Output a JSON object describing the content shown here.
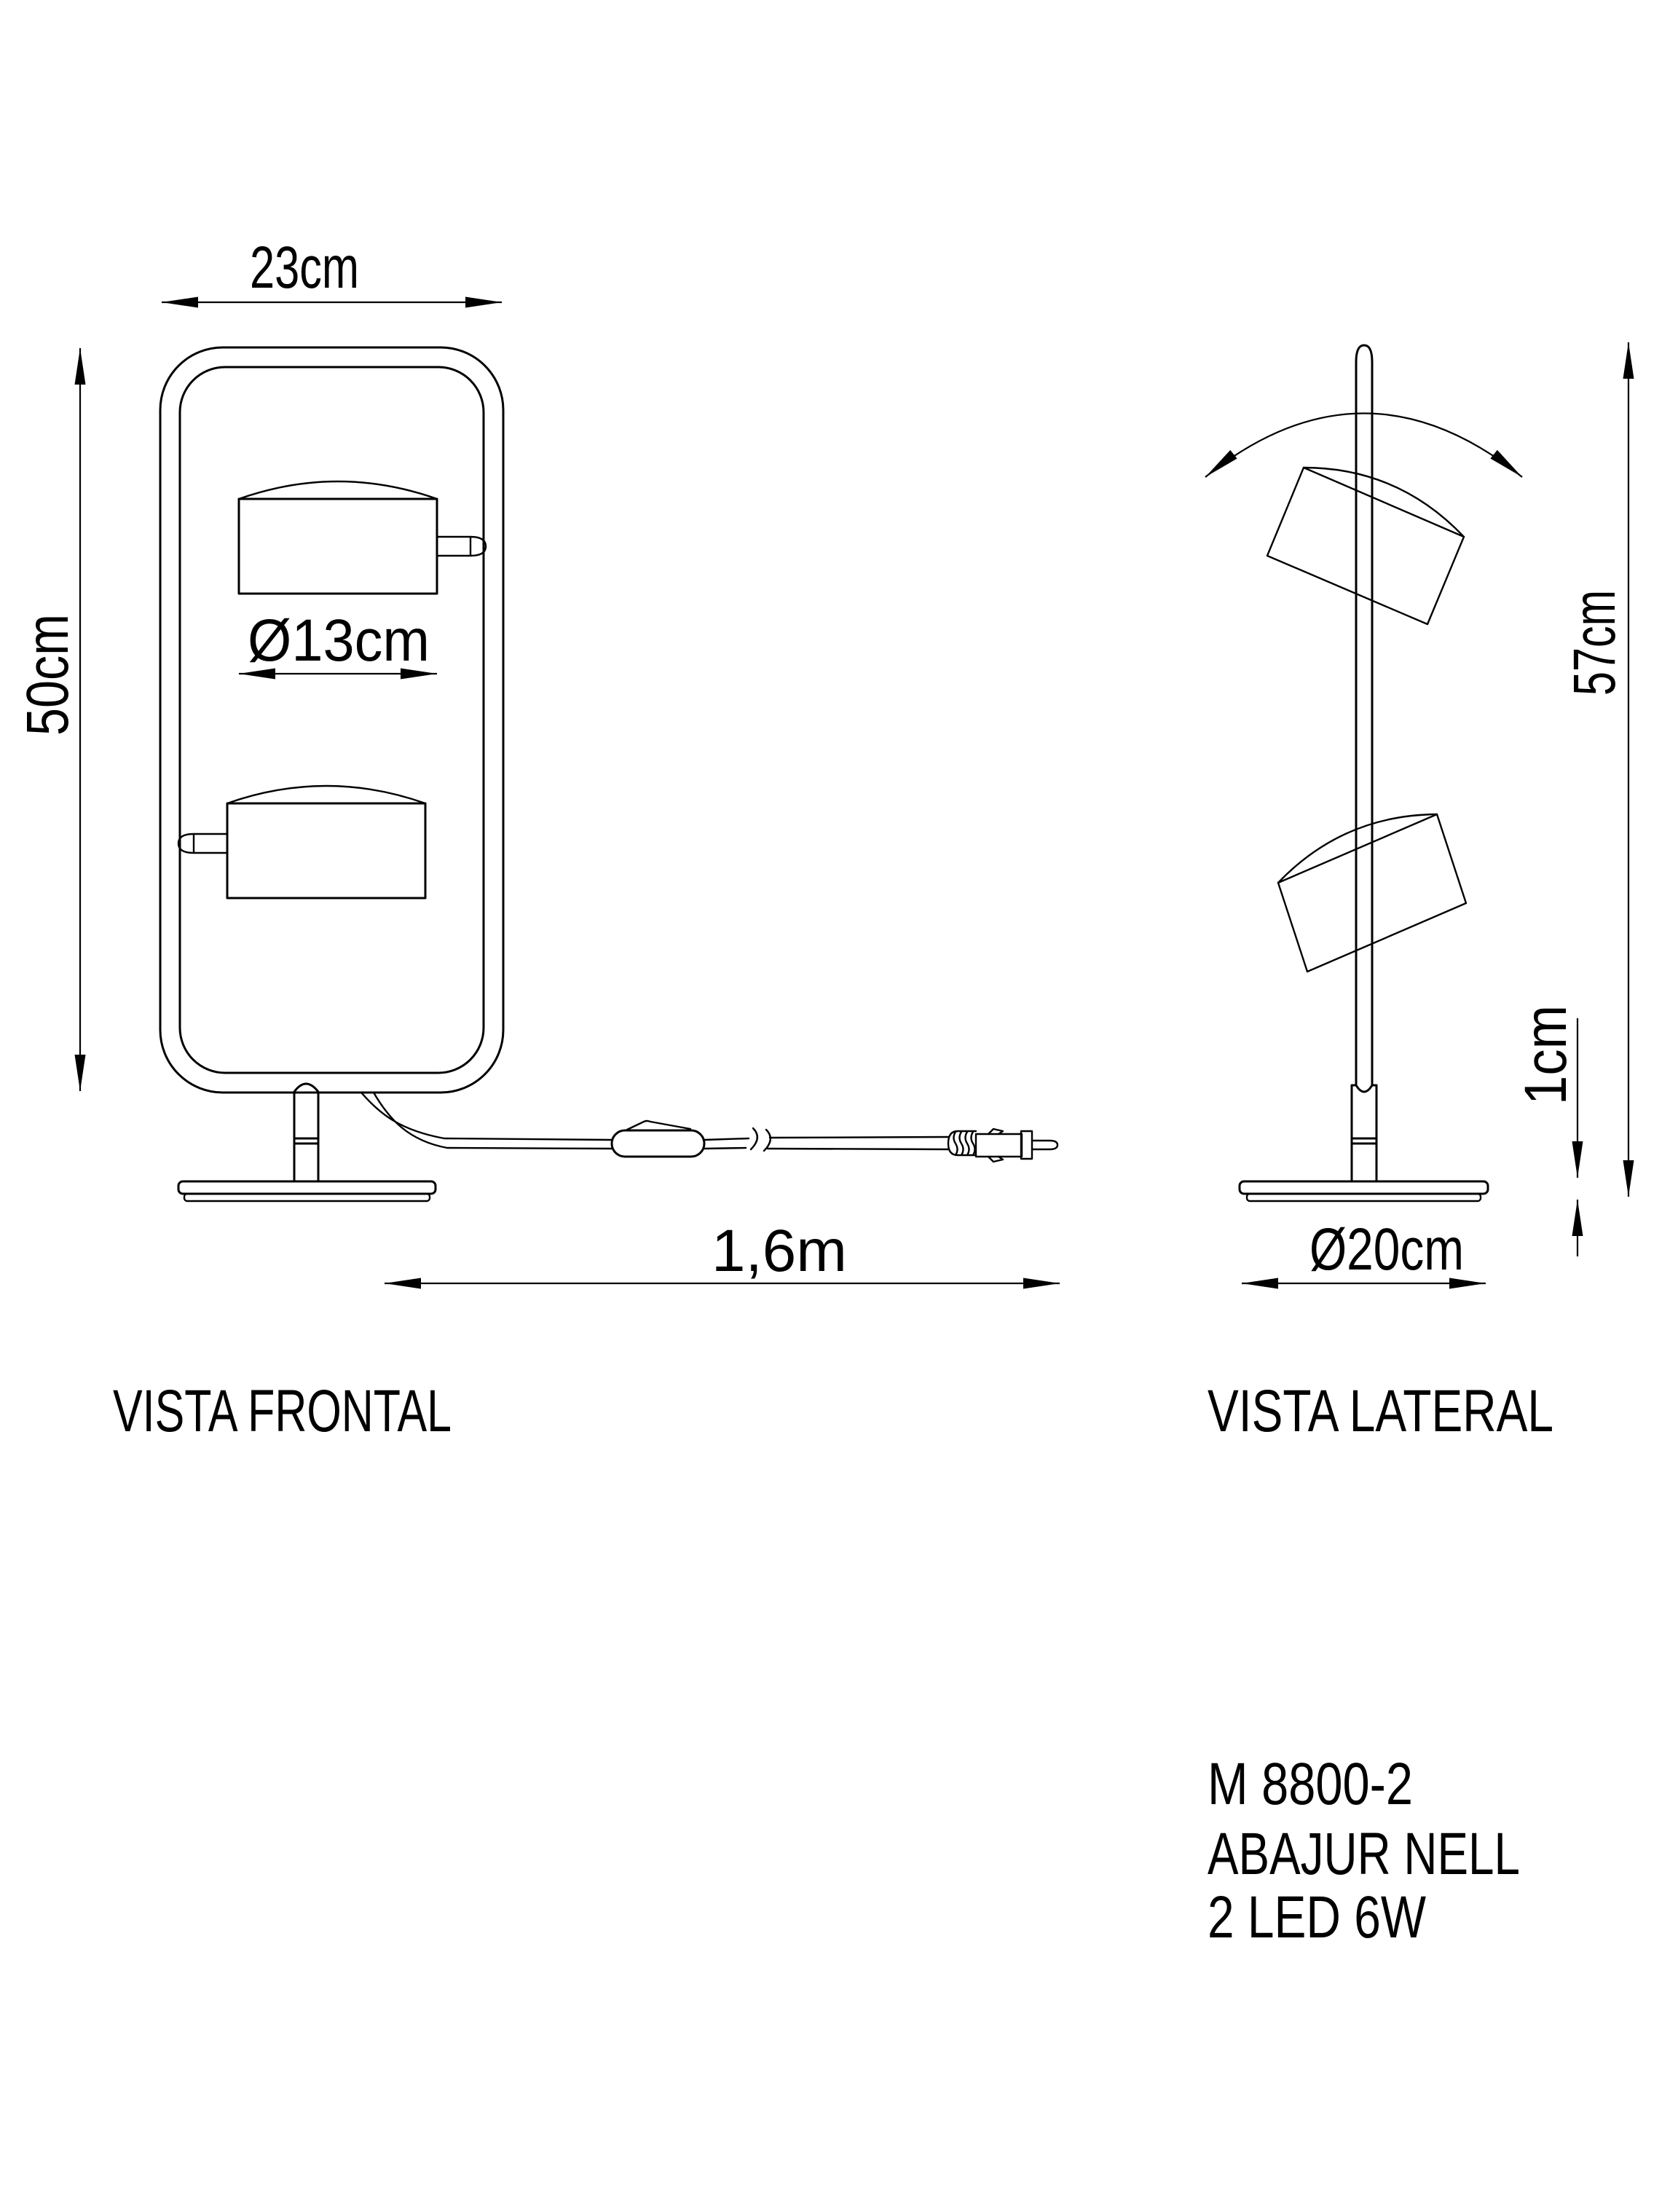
{
  "colors": {
    "background": "#ffffff",
    "line": "#000000"
  },
  "front_view": {
    "caption": "VISTA FRONTAL",
    "dim_width": "23cm",
    "dim_height": "50cm",
    "dim_shade_diameter": "Ø13cm",
    "dim_cable_length": "1,6m"
  },
  "side_view": {
    "caption": "VISTA LATERAL",
    "dim_height": "57cm",
    "dim_base_thickness": "1cm",
    "dim_base_diameter": "Ø20cm"
  },
  "product_info": {
    "model": "M 8800-2",
    "name": "ABAJUR NELL",
    "spec": "2 LED 6W"
  }
}
